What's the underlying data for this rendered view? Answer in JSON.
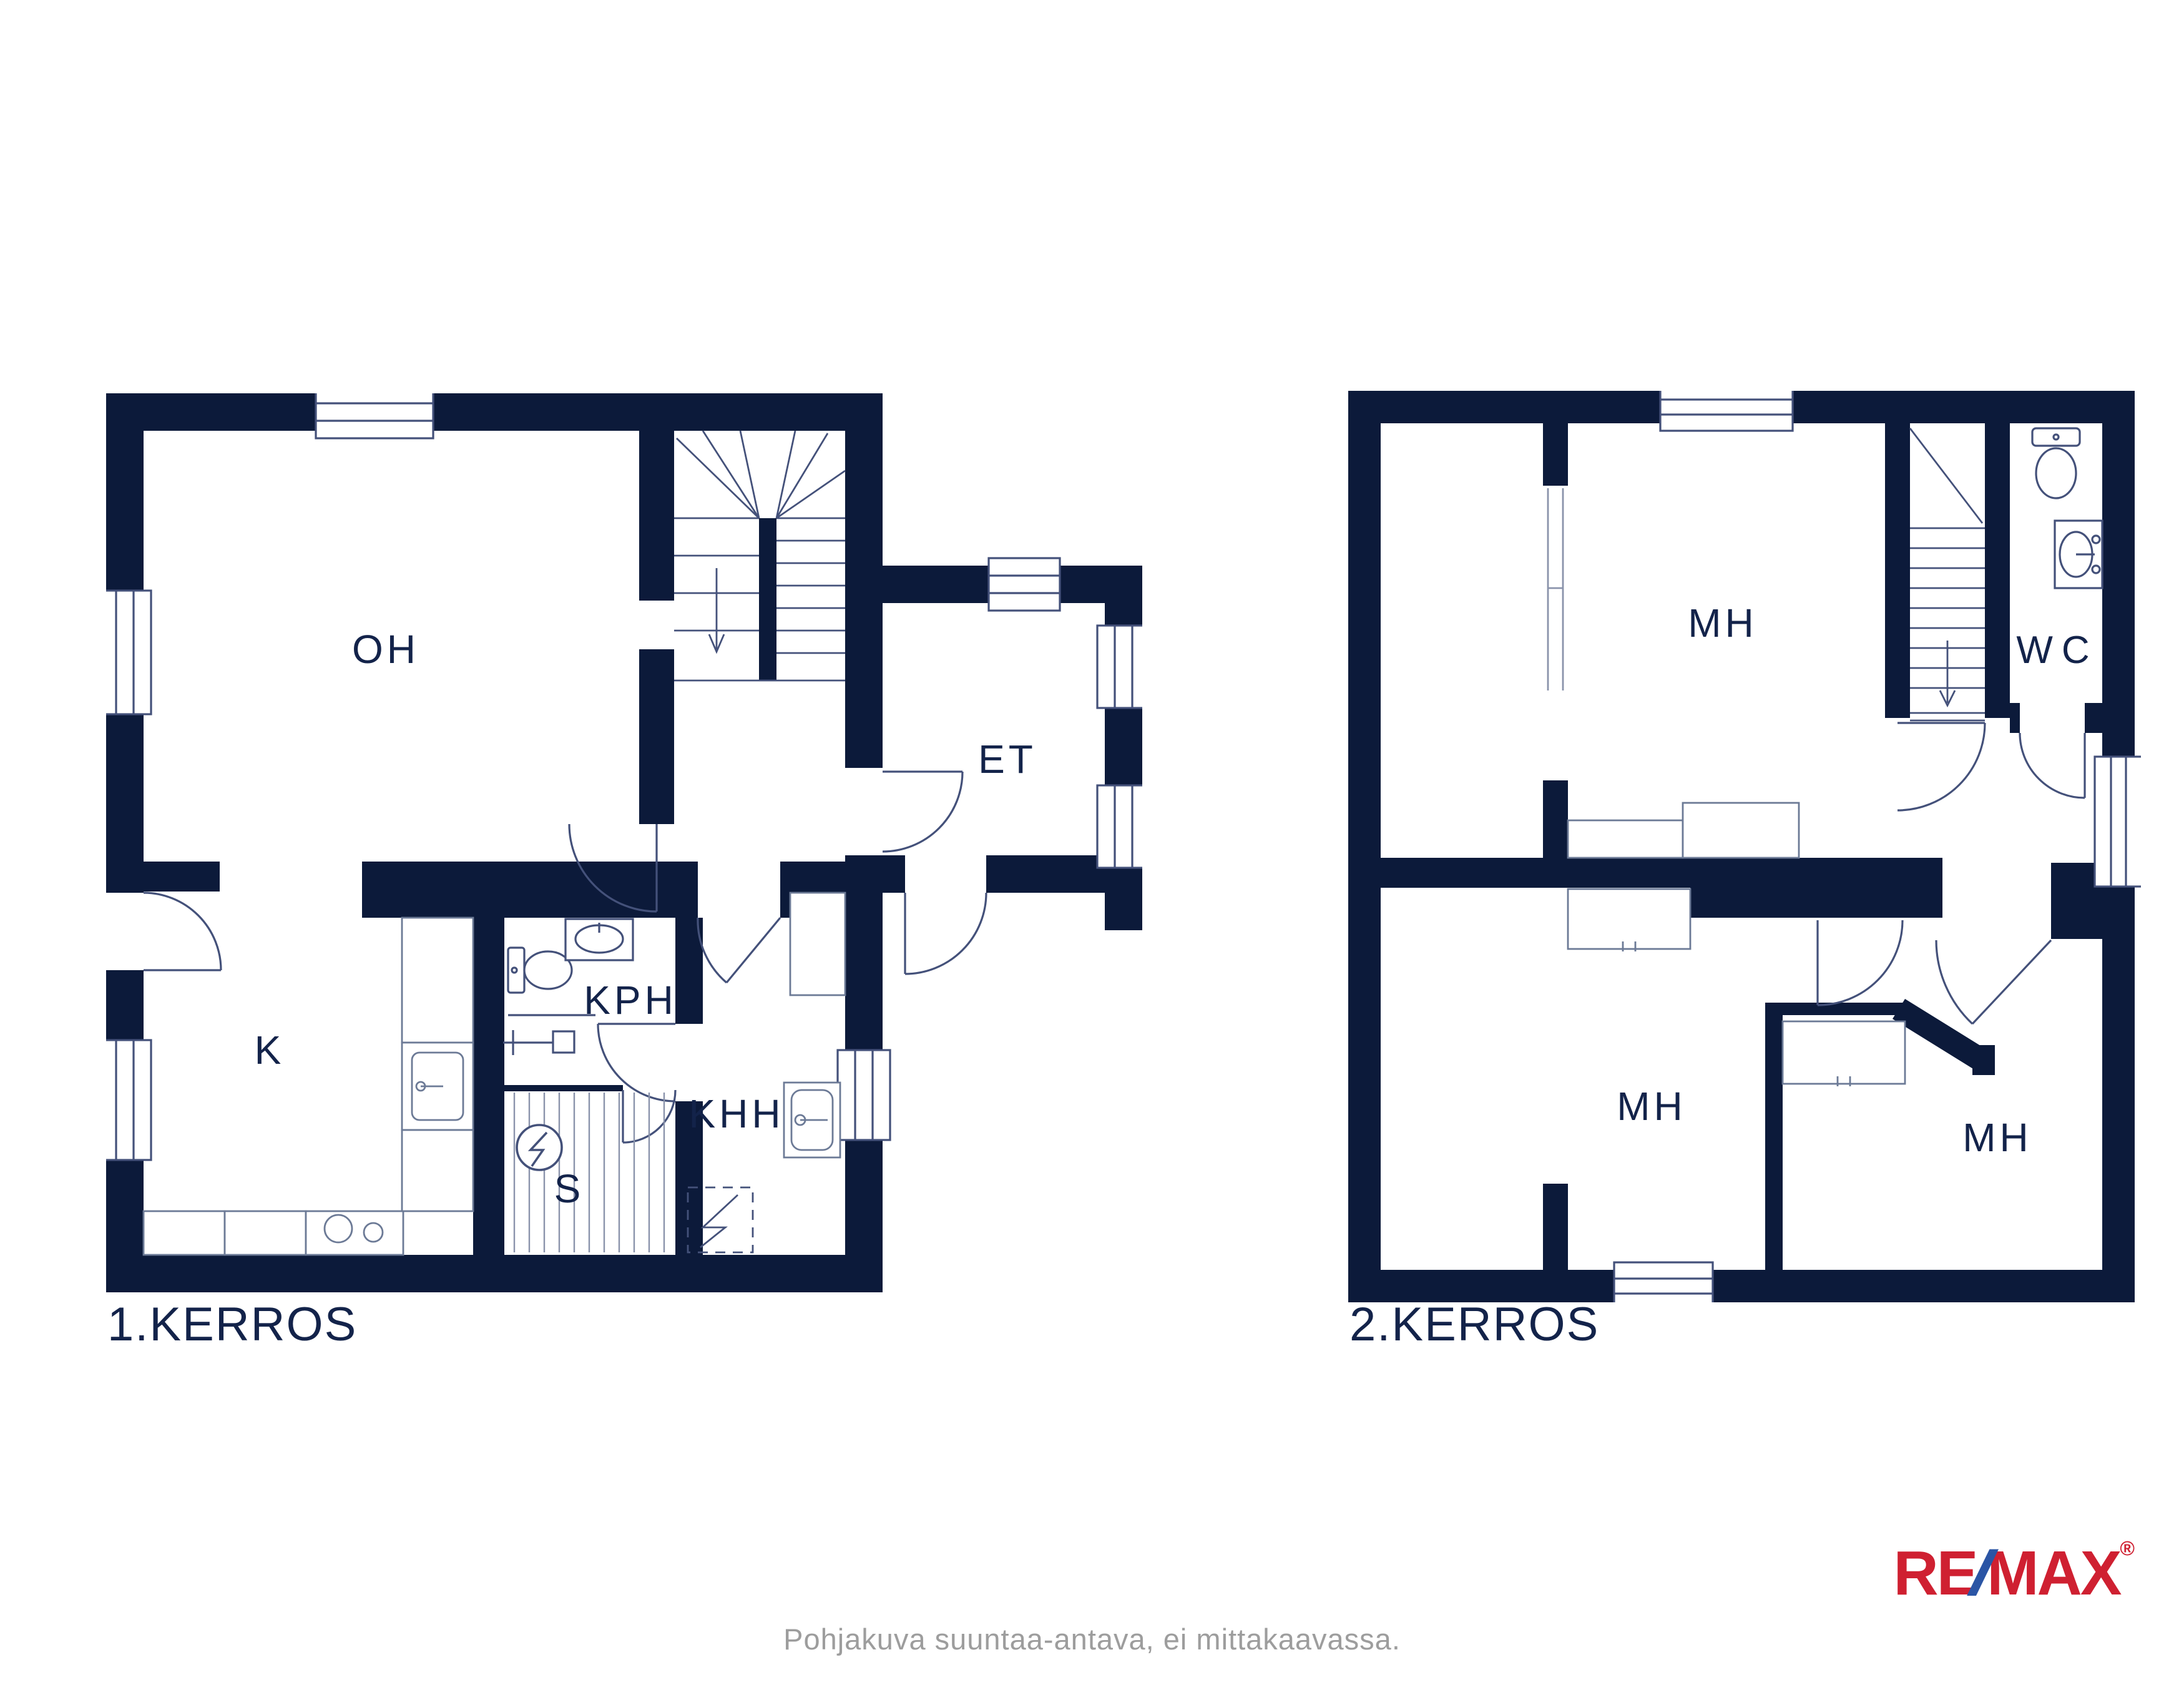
{
  "colors": {
    "wall_navy": "#0c1a3a",
    "thin_line": "#44517a",
    "light_line": "#6c7a96",
    "label_navy": "#13234a",
    "caption_gray": "#9d9d9d",
    "logo_red": "#cf2031",
    "logo_blue": "#2b55a5"
  },
  "floor1": {
    "title": "1.KERROS",
    "room_labels": {
      "oh": "OH",
      "k": "K",
      "kph": "KPH",
      "s": "S",
      "khh": "KHH",
      "et": "ET"
    }
  },
  "floor2": {
    "title": "2.KERROS",
    "room_labels": {
      "mh_top": "MH",
      "mh_left": "MH",
      "mh_right": "MH",
      "wc": "WC"
    }
  },
  "footer": {
    "caption": "Pohjakuva suuntaa-antava, ei mittakaavassa."
  },
  "logo": {
    "re": "RE",
    "slash": "/",
    "max": "MAX",
    "registered": "®"
  }
}
